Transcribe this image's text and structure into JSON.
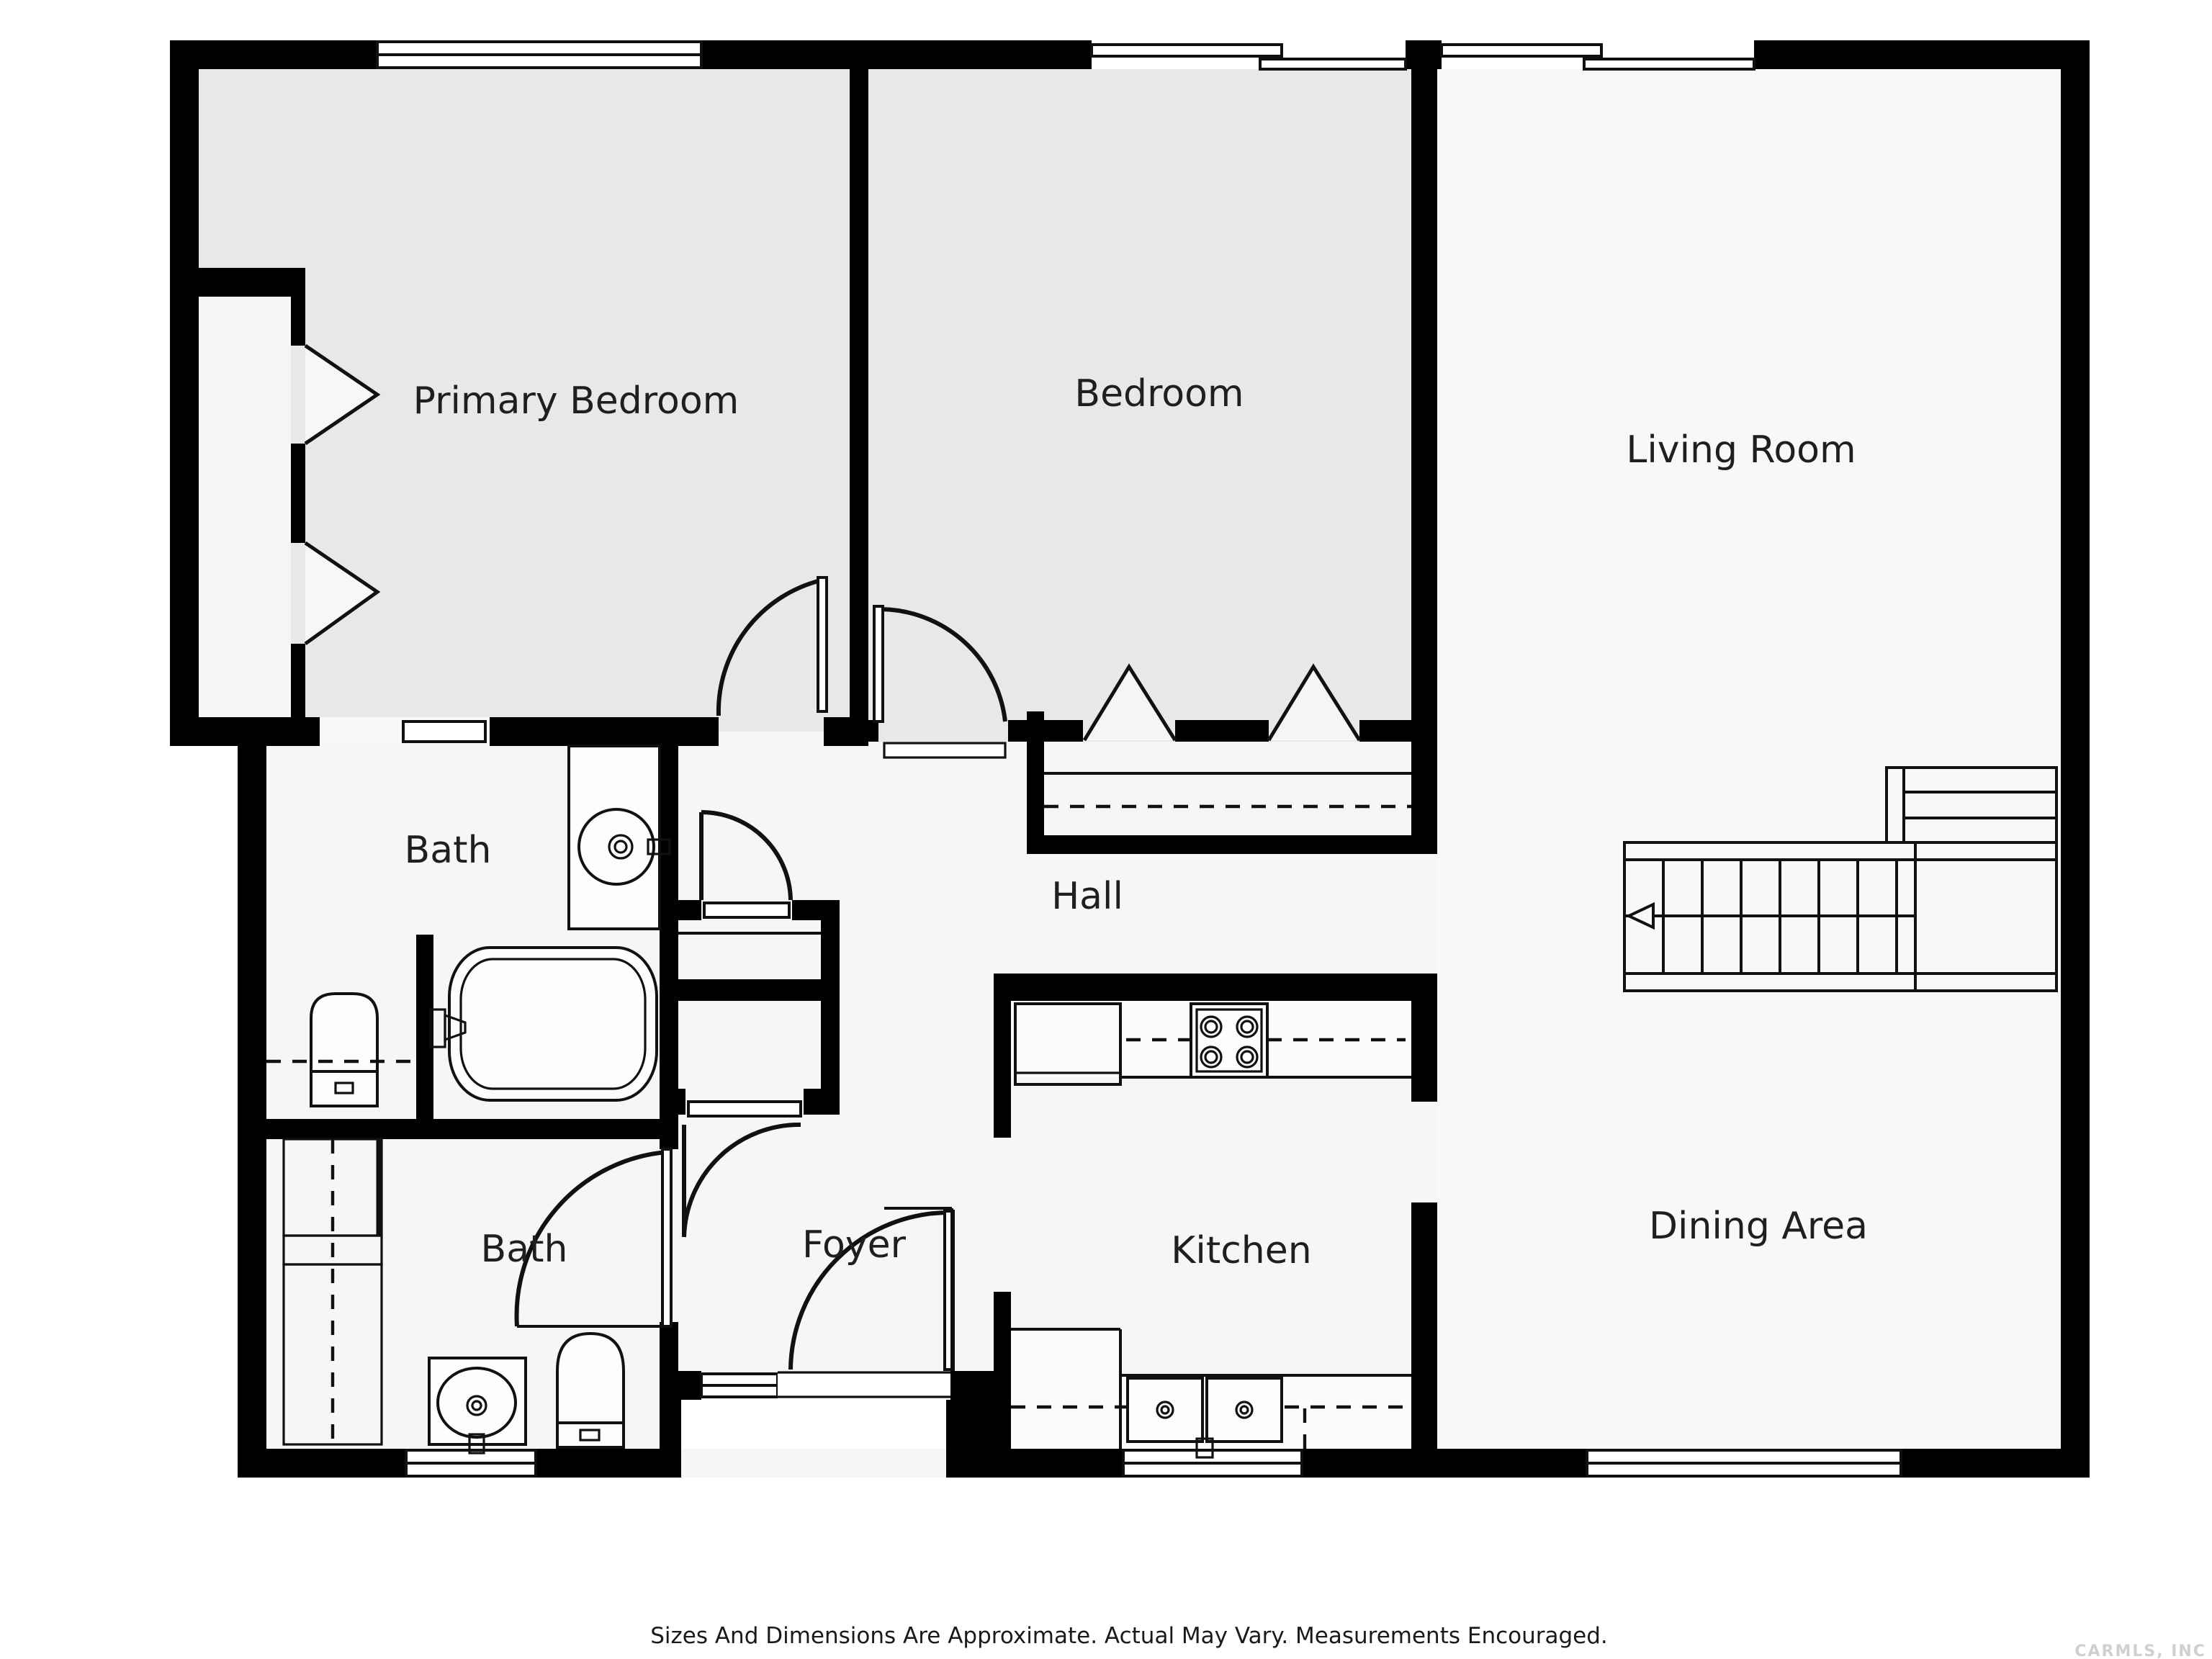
{
  "floorplan": {
    "rooms": {
      "primary_bedroom": {
        "label": "Primary Bedroom"
      },
      "bedroom": {
        "label": "Bedroom"
      },
      "living_room": {
        "label": "Living Room"
      },
      "bath_upper": {
        "label": "Bath"
      },
      "hall": {
        "label": "Hall"
      },
      "bath_lower": {
        "label": "Bath"
      },
      "foyer": {
        "label": "Foyer"
      },
      "kitchen": {
        "label": "Kitchen"
      },
      "dining_area": {
        "label": "Dining Area"
      }
    },
    "colors": {
      "wall": "#000000",
      "bedroom_fill": "#e8e8e8",
      "floor_fill": "#f6f6f6",
      "living_fill": "#f8f8f8",
      "closet_fill": "#f5f5f5"
    },
    "footer": {
      "disclaimer": "Sizes And Dimensions Are Approximate. Actual May Vary. Measurements Encouraged."
    },
    "watermark": {
      "text": "CARMLS, INC"
    }
  }
}
